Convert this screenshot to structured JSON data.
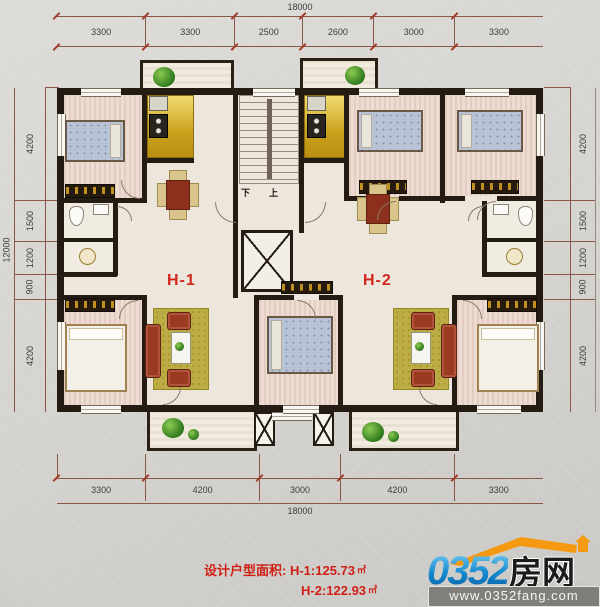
{
  "dims": {
    "top": {
      "total": "18000",
      "segments": [
        "3300",
        "3300",
        "2500",
        "2600",
        "3000",
        "3300"
      ]
    },
    "bottom": {
      "total": "18000",
      "segments": [
        "3300",
        "4200",
        "3000",
        "4200",
        "3300"
      ]
    },
    "left": {
      "total": "12000",
      "segments": [
        "4200",
        "1500",
        "1200",
        "900",
        "4200"
      ]
    },
    "right": {
      "segments": [
        "4200",
        "1500",
        "1200",
        "900",
        "4200"
      ]
    }
  },
  "units": {
    "h1": "H-1",
    "h2": "H-2"
  },
  "stairsTxt": {
    "down": "下",
    "up": "上"
  },
  "caption": {
    "label": "设计户型面积:",
    "h1_area": "H-1:125.73",
    "h2_area": "H-2:122.93",
    "unit": "㎡"
  },
  "logo": {
    "number": "0352",
    "name": "房网",
    "url": "www.0352fang.com"
  },
  "colors": {
    "label_red": "#d0261c",
    "dim_line": "#8a5848",
    "wall": "#241c12",
    "kitchen_gold": "#d7b335",
    "logo_blue": "#1489cf",
    "logo_orange": "#f59a10"
  }
}
